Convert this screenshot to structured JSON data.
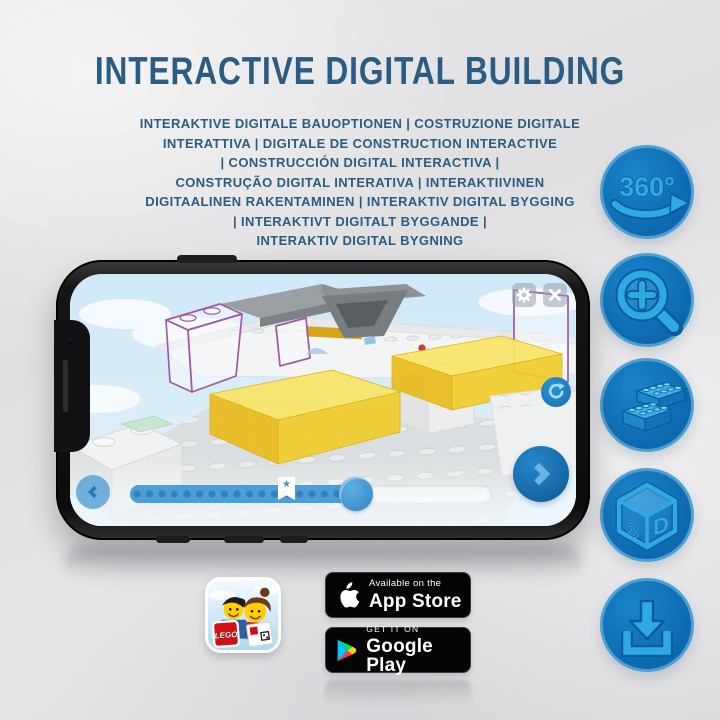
{
  "header": {
    "title": "INTERACTIVE DIGITAL BUILDING",
    "subtitle_lines": [
      "INTERAKTIVE DIGITALE BAUOPTIONEN | COSTRUZIONE DIGITALE",
      "INTERATTIVA | DIGITALE DE CONSTRUCTION INTERACTIVE",
      "| CONSTRUCCIÓN DIGITAL INTERACTIVA |",
      "CONSTRUÇÃO DIGITAL INTERATIVA | INTERAKTIIVINEN",
      "DIGITAALINEN RAKENTAMINEN | INTERAKTIV DIGITAL BYGGING",
      "| INTERAKTIVT DIGITALT BYGGANDE |",
      "INTERAKTIV DIGITAL BYGNING"
    ]
  },
  "feature_icons": [
    {
      "icon": "rotate-360-icon",
      "label": "360°"
    },
    {
      "icon": "zoom-in-icon"
    },
    {
      "icon": "lego-bricks-icon"
    },
    {
      "icon": "cube-3d-icon",
      "label_3": "3",
      "label_d": "D"
    },
    {
      "icon": "download-icon"
    }
  ],
  "phone_app": {
    "progress_percent": 65,
    "bookmark_percent": 43,
    "bookmark_glyph": "★",
    "icons": {
      "settings": "gear-icon",
      "close": "close-icon",
      "rotate": "rotate-icon",
      "previous": "chevron-left-icon",
      "next": "chevron-right-icon",
      "bookmark": "bookmark-star-icon"
    }
  },
  "footer": {
    "app_icon_brand": "LEGO",
    "app_store": {
      "tagline": "Available on the",
      "name": "App Store"
    },
    "google_play": {
      "tagline": "GET IT ON",
      "name": "Google Play"
    }
  },
  "colors": {
    "title_blue": "#2b5c82",
    "badge_circle_blue": "#0d68ae",
    "glyph_blue": "#2fa9e4",
    "screen_sky": "#cfe9f7",
    "brick_yellow": "#f2cd2d",
    "ghost_outline_purple": "#a05aa8",
    "store_badge_black": "#040404"
  }
}
